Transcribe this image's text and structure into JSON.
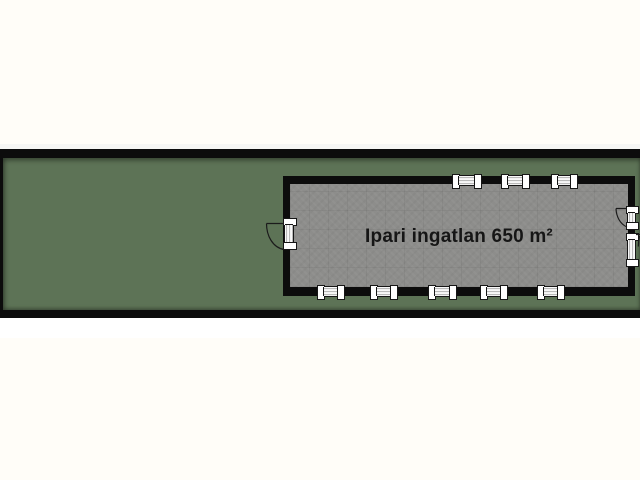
{
  "floorplan": {
    "building_label": "Ipari ingatlan 650 m²",
    "colors": {
      "page_background": "#fffdf8",
      "plot_green": "#5d7356",
      "wall_black": "#0c0c0c",
      "floor_gray": "#8d8d8b",
      "opening_white": "#ffffff",
      "label_text": "#161616"
    },
    "window_count_top": 3,
    "window_count_bottom": 5,
    "window_count_right": 1,
    "door_count": 2
  }
}
